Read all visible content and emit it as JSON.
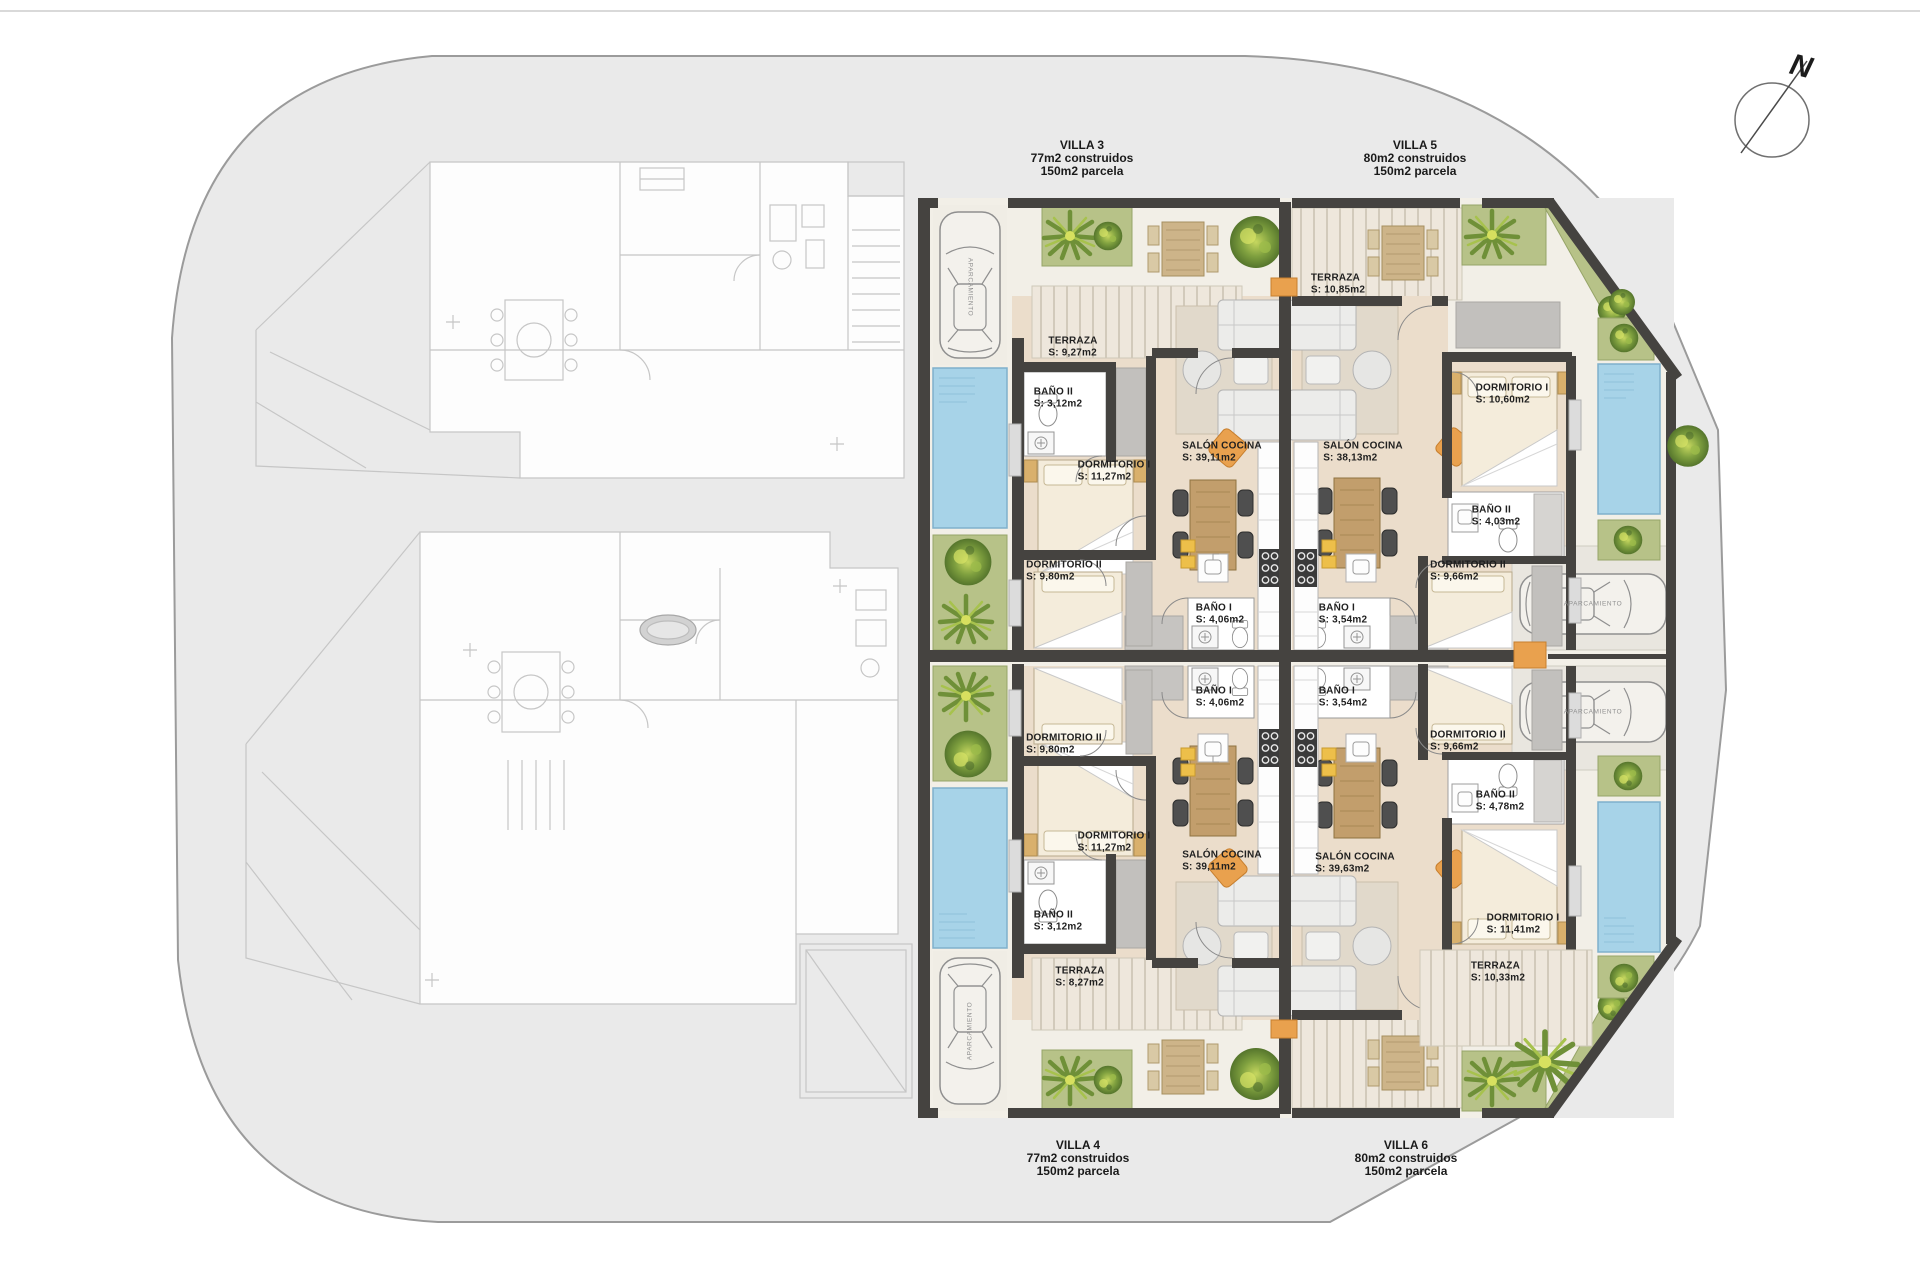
{
  "compass": {
    "label": "N"
  },
  "parking_label": "APARCAMIENTO",
  "villas": {
    "v3": {
      "title": "VILLA 3",
      "built": "77m2 construidos",
      "plot": "150m2 parcela"
    },
    "v5": {
      "title": "VILLA 5",
      "built": "80m2 construidos",
      "plot": "150m2 parcela"
    },
    "v4": {
      "title": "VILLA 4",
      "built": "77m2 construidos",
      "plot": "150m2 parcela"
    },
    "v6": {
      "title": "VILLA 6",
      "built": "80m2 construidos",
      "plot": "150m2 parcela"
    }
  },
  "rooms": {
    "v3_terraza": {
      "name": "TERRAZA",
      "area": "S: 9,27m2"
    },
    "v3_bano2": {
      "name": "BAÑO II",
      "area": "S: 3,12m2"
    },
    "v3_dorm1": {
      "name": "DORMITORIO I",
      "area": "S: 11,27m2"
    },
    "v3_dorm2": {
      "name": "DORMITORIO II",
      "area": "S: 9,80m2"
    },
    "v3_salon": {
      "name": "SALÓN COCINA",
      "area": "S: 39,11m2"
    },
    "v3_bano1": {
      "name": "BAÑO I",
      "area": "S: 4,06m2"
    },
    "v5_terraza": {
      "name": "TERRAZA",
      "area": "S: 10,85m2"
    },
    "v5_dorm1": {
      "name": "DORMITORIO I",
      "area": "S: 10,60m2"
    },
    "v5_bano2": {
      "name": "BAÑO II",
      "area": "S: 4,03m2"
    },
    "v5_dorm2": {
      "name": "DORMITORIO II",
      "area": "S: 9,66m2"
    },
    "v5_salon": {
      "name": "SALÓN COCINA",
      "area": "S: 38,13m2"
    },
    "v5_bano1": {
      "name": "BAÑO I",
      "area": "S: 3,54m2"
    },
    "v4_bano1": {
      "name": "BAÑO I",
      "area": "S: 4,06m2"
    },
    "v4_dorm2": {
      "name": "DORMITORIO II",
      "area": "S: 9,80m2"
    },
    "v4_dorm1": {
      "name": "DORMITORIO I",
      "area": "S: 11,27m2"
    },
    "v4_salon": {
      "name": "SALÓN COCINA",
      "area": "S: 39,11m2"
    },
    "v4_bano2": {
      "name": "BAÑO II",
      "area": "S: 3,12m2"
    },
    "v4_terraza": {
      "name": "TERRAZA",
      "area": "S: 8,27m2"
    },
    "v6_bano1": {
      "name": "BAÑO I",
      "area": "S: 3,54m2"
    },
    "v6_dorm2": {
      "name": "DORMITORIO II",
      "area": "S: 9,66m2"
    },
    "v6_salon": {
      "name": "SALÓN COCINA",
      "area": "S: 39,63m2"
    },
    "v6_bano2": {
      "name": "BAÑO II",
      "area": "S: 4,78m2"
    },
    "v6_dorm1": {
      "name": "DORMITORIO I",
      "area": "S: 11,41m2"
    },
    "v6_terraza": {
      "name": "TERRAZA",
      "area": "S: 10,33m2"
    }
  },
  "colors": {
    "wall": "#454340",
    "floor": "#ebddcb",
    "pool": "#a7d3e8",
    "green": "#b7c288",
    "accent_orange": "#e9a14e",
    "site": "#eaeaea"
  }
}
